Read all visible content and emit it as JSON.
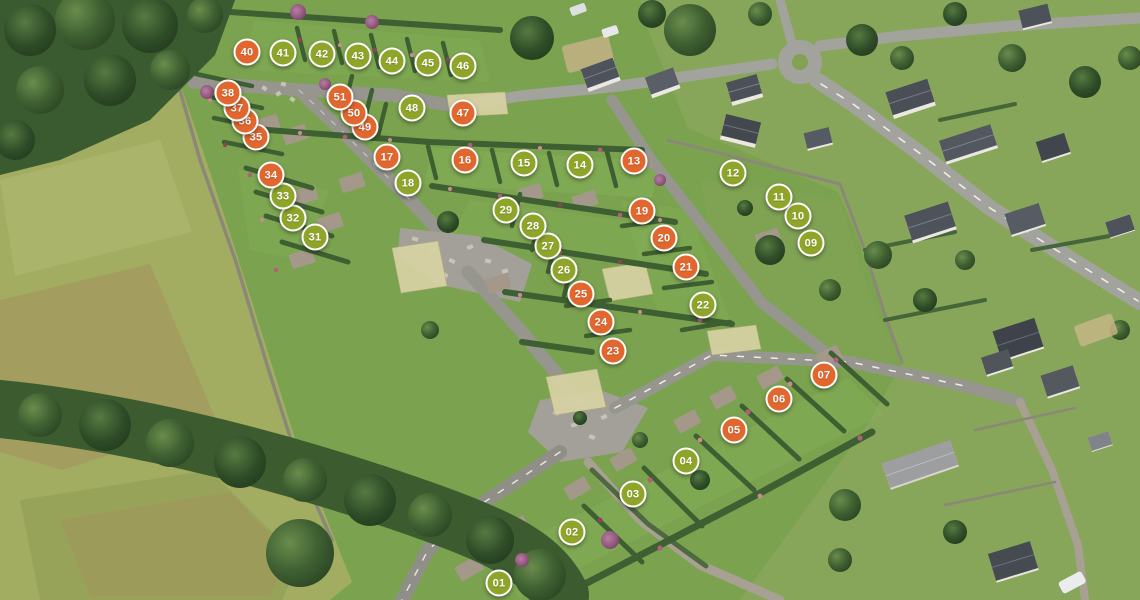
{
  "map": {
    "legend_colors": {
      "green": "#8fa52a",
      "orange": "#e2672e"
    },
    "markers": [
      {
        "label": "01",
        "color": "green",
        "x": 499,
        "y": 583
      },
      {
        "label": "02",
        "color": "green",
        "x": 572,
        "y": 532
      },
      {
        "label": "03",
        "color": "green",
        "x": 633,
        "y": 494
      },
      {
        "label": "04",
        "color": "green",
        "x": 686,
        "y": 461
      },
      {
        "label": "05",
        "color": "orange",
        "x": 734,
        "y": 430
      },
      {
        "label": "06",
        "color": "orange",
        "x": 779,
        "y": 399
      },
      {
        "label": "07",
        "color": "orange",
        "x": 824,
        "y": 375
      },
      {
        "label": "09",
        "color": "green",
        "x": 811,
        "y": 243
      },
      {
        "label": "10",
        "color": "green",
        "x": 798,
        "y": 216
      },
      {
        "label": "11",
        "color": "green",
        "x": 779,
        "y": 197
      },
      {
        "label": "12",
        "color": "green",
        "x": 733,
        "y": 173
      },
      {
        "label": "13",
        "color": "orange",
        "x": 634,
        "y": 161
      },
      {
        "label": "14",
        "color": "green",
        "x": 580,
        "y": 165
      },
      {
        "label": "15",
        "color": "green",
        "x": 524,
        "y": 163
      },
      {
        "label": "16",
        "color": "orange",
        "x": 465,
        "y": 160
      },
      {
        "label": "17",
        "color": "orange",
        "x": 387,
        "y": 157
      },
      {
        "label": "18",
        "color": "green",
        "x": 408,
        "y": 183
      },
      {
        "label": "19",
        "color": "orange",
        "x": 642,
        "y": 211
      },
      {
        "label": "20",
        "color": "orange",
        "x": 664,
        "y": 238
      },
      {
        "label": "21",
        "color": "orange",
        "x": 686,
        "y": 267
      },
      {
        "label": "22",
        "color": "green",
        "x": 703,
        "y": 305
      },
      {
        "label": "23",
        "color": "orange",
        "x": 613,
        "y": 351
      },
      {
        "label": "24",
        "color": "orange",
        "x": 601,
        "y": 322
      },
      {
        "label": "25",
        "color": "orange",
        "x": 581,
        "y": 294
      },
      {
        "label": "26",
        "color": "green",
        "x": 564,
        "y": 270
      },
      {
        "label": "27",
        "color": "green",
        "x": 548,
        "y": 246
      },
      {
        "label": "28",
        "color": "green",
        "x": 533,
        "y": 226
      },
      {
        "label": "29",
        "color": "green",
        "x": 506,
        "y": 210
      },
      {
        "label": "31",
        "color": "green",
        "x": 315,
        "y": 237
      },
      {
        "label": "32",
        "color": "green",
        "x": 293,
        "y": 218
      },
      {
        "label": "33",
        "color": "green",
        "x": 283,
        "y": 196
      },
      {
        "label": "34",
        "color": "orange",
        "x": 271,
        "y": 175
      },
      {
        "label": "35",
        "color": "orange",
        "x": 256,
        "y": 137
      },
      {
        "label": "36",
        "color": "orange",
        "x": 245,
        "y": 121
      },
      {
        "label": "37",
        "color": "orange",
        "x": 237,
        "y": 108
      },
      {
        "label": "38",
        "color": "orange",
        "x": 228,
        "y": 93
      },
      {
        "label": "40",
        "color": "orange",
        "x": 247,
        "y": 52
      },
      {
        "label": "41",
        "color": "green",
        "x": 283,
        "y": 53
      },
      {
        "label": "42",
        "color": "green",
        "x": 322,
        "y": 54
      },
      {
        "label": "43",
        "color": "green",
        "x": 358,
        "y": 56
      },
      {
        "label": "44",
        "color": "green",
        "x": 392,
        "y": 61
      },
      {
        "label": "45",
        "color": "green",
        "x": 428,
        "y": 63
      },
      {
        "label": "46",
        "color": "green",
        "x": 463,
        "y": 66
      },
      {
        "label": "47",
        "color": "orange",
        "x": 463,
        "y": 113
      },
      {
        "label": "48",
        "color": "green",
        "x": 412,
        "y": 108
      },
      {
        "label": "49",
        "color": "orange",
        "x": 365,
        "y": 127
      },
      {
        "label": "50",
        "color": "orange",
        "x": 354,
        "y": 113
      },
      {
        "label": "51",
        "color": "orange",
        "x": 340,
        "y": 97
      }
    ]
  }
}
